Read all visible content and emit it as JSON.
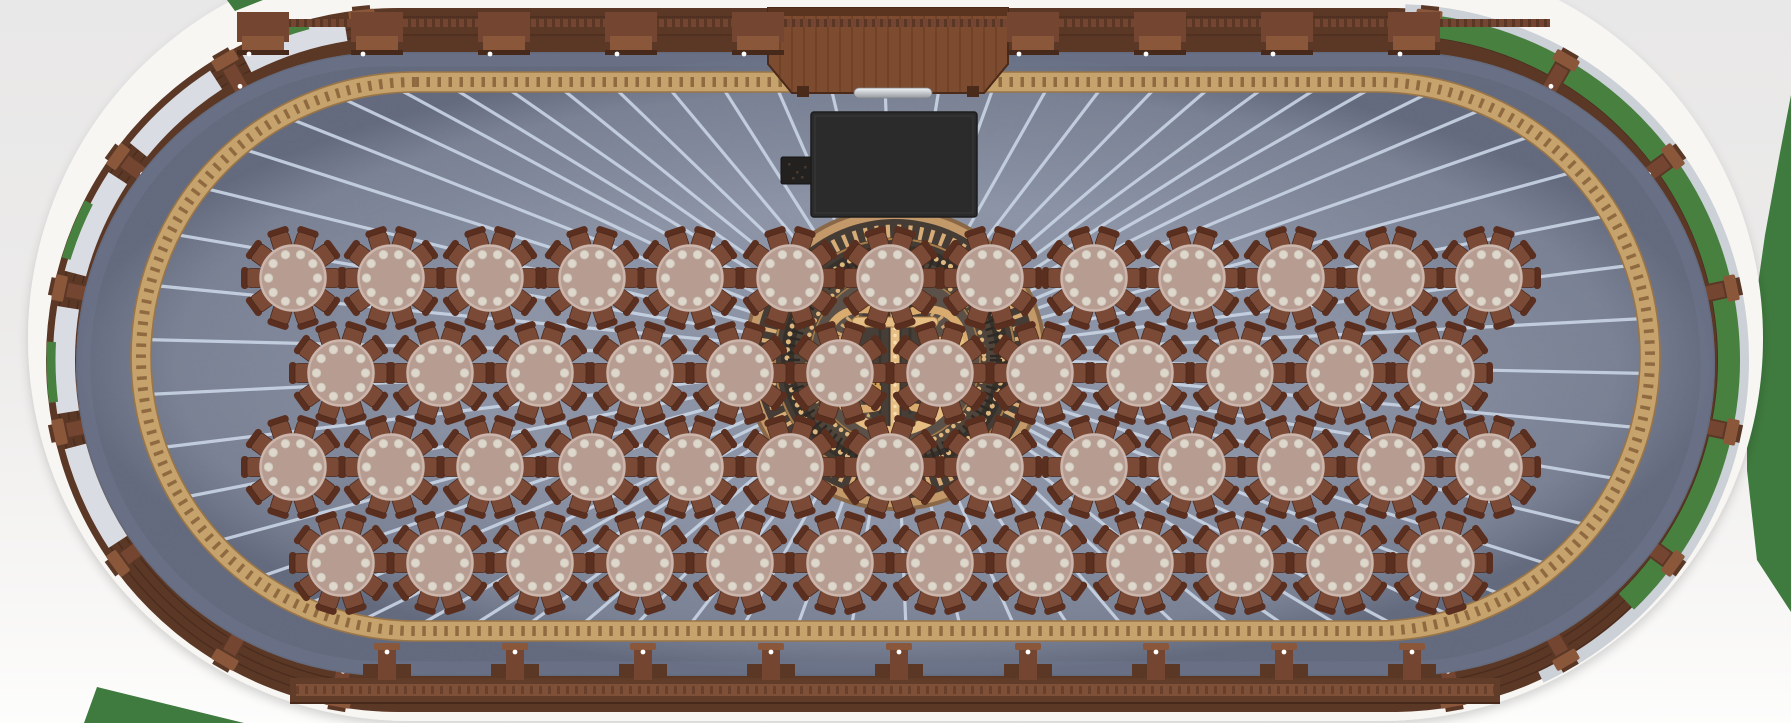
{
  "scene": {
    "title": "Oval banquet hall seating plan (top-down render)",
    "room_shape": "stadium oval with rounded ends",
    "floor": "blue-gray carpet with white sunburst rays radiating from center medallion",
    "centerpiece": "ornate circular wood-inlay medallion with gold anchor motif and laurel rings",
    "table_count": 50,
    "seats_per_table": 10,
    "plates_per_table": 10,
    "total_seats": 500,
    "objects": [
      "round dining tables",
      "dining chairs",
      "grand piano",
      "piano bench",
      "wooden stage platform with footlight bar",
      "laurel border ring",
      "perimeter wood consoles with lamp dots",
      "window bays with white curtains",
      "green outdoors visible through right-end windows"
    ]
  },
  "palette": {
    "wall": "#f7f6f3",
    "wall_shadow": "rgba(60,60,60,0.18)",
    "wood_dark": "#5b3726",
    "wood_mid": "#744631",
    "wood_light": "#8a573a",
    "wood_line": "#46291b",
    "carpet": "#8b93a6",
    "carpet_edge": "#6f7790",
    "ray": "#c7d3e3",
    "ring_gold": "#c6a26c",
    "ring_chevron": "#8f6a40",
    "ring_edge": "#9a7548",
    "curtain": "#d9dce2",
    "glass_green": "#47803f",
    "sill": "#ccd0d7",
    "outside_green": "#3f7a3e",
    "med_rim": "#c3996a",
    "med_rim_edge": "#8a6847",
    "med_ring_dark": "#453c35",
    "med_leaf": "#d7ac76",
    "med_dark2": "#37312b",
    "med_bead": "#dfb67d",
    "med_tex": "#50453b",
    "med_tex_dash": "#2e2924",
    "med_inner": "#5b5148",
    "med_scroll": "#d9ab6e",
    "med_field": "#473f37",
    "med_stripe": "#3b342d",
    "anchor": "#e6bd82",
    "anchor_bead": "#f7ddb0",
    "anchor_edge": "#a87c48",
    "crown": "#d3a254",
    "table_top": "#b79c92",
    "table_rim": "#ccb6ab",
    "plate": "#ded7cb",
    "plate_edge": "#cfc8bb",
    "chair_seat": "#7b4a37",
    "chair_back": "#5a2f20",
    "chair_edge": "#4c2a1c",
    "stage_wood": "#7d4b30",
    "stage_line": "#66391f",
    "stage_trim": "#4a2a19",
    "stage_top": "#5b3420",
    "silver_hi": "#f2f4f6",
    "silver_lo": "#94989e",
    "piano": "#2c2b2b",
    "piano_edge": "#1d1c1c",
    "piano_inner": "#3a3939",
    "bench": "#232120",
    "dot_light": "#ffffff"
  },
  "geometry": {
    "canvas": {
      "w": 1791,
      "h": 723
    },
    "center": {
      "x": 895,
      "y": 358
    },
    "wall": {
      "left": 28,
      "right": 1763,
      "top": -44,
      "bottom": 721
    },
    "wood": {
      "left": 46,
      "right": 1745,
      "top": 8,
      "bottom": 712
    },
    "carpet": {
      "left": 76,
      "right": 1715,
      "top": 52,
      "bottom": 676
    },
    "ring": {
      "left": 141,
      "right": 1650,
      "top": 82,
      "bottom": 631
    },
    "rays": {
      "count": 66,
      "width": 3.2
    },
    "ends": {
      "left_center": {
        "x": 398,
        "y": 360
      },
      "right_center": {
        "x": 1393,
        "y": 360
      },
      "window_alphas": [
        18,
        42,
        66,
        90,
        114
      ],
      "window_half_span": 9,
      "console_alphas": [
        6,
        30,
        54,
        78,
        102,
        126,
        150,
        170
      ],
      "left_green_alphas": [
        20,
        68,
        92
      ],
      "right_green_span": [
        6,
        136
      ],
      "right_sill_span": [
        2,
        155
      ],
      "r_curtain": 334,
      "r_green_left": 347,
      "r_green_right": 336,
      "r_sill": 350,
      "r_console": 324
    },
    "brackets": {
      "top_xs": [
        263,
        377,
        504,
        631,
        758,
        1033,
        1160,
        1287,
        1414
      ],
      "bottom_xs": [
        387,
        515,
        643,
        771,
        899,
        1028,
        1156,
        1284,
        1412
      ]
    }
  },
  "medallion": {
    "cx": 895,
    "cy": 359,
    "outer_r": 152,
    "motif": "gold anchor with crowns, acanthus scrolls, laurel and bead rings"
  },
  "stage": {
    "points": "768,8 1008,8 1008,64 984,93 792,93 768,64",
    "footlight": {
      "x": 854,
      "y": 88,
      "w": 78,
      "h": 10
    }
  },
  "piano": {
    "x": 811,
    "y": 112,
    "w": 166,
    "h": 105,
    "bench": {
      "x": 781,
      "y": 157,
      "w": 34,
      "h": 27
    }
  },
  "tables": {
    "radius": 32.5,
    "chair_count": 10,
    "plate_count": 10,
    "rows": [
      {
        "y": 278,
        "xs": [
          293,
          391,
          490,
          592,
          690,
          790,
          890,
          990,
          1094,
          1192,
          1291,
          1391,
          1489
        ]
      },
      {
        "y": 373,
        "xs": [
          341,
          440,
          540,
          640,
          740,
          840,
          940,
          1040,
          1140,
          1240,
          1340,
          1441
        ]
      },
      {
        "y": 467,
        "xs": [
          293,
          391,
          490,
          592,
          690,
          790,
          890,
          990,
          1094,
          1192,
          1291,
          1391,
          1489
        ]
      },
      {
        "y": 563,
        "xs": [
          341,
          440,
          540,
          640,
          740,
          840,
          940,
          1040,
          1140,
          1240,
          1340,
          1441
        ]
      }
    ]
  },
  "green_accents": {
    "top_right_poly": "1552,0 1791,0 1791,612 1757,560 1747,470 1747,400 1753,320 1765,235 1779,158 1791,95 1791,0",
    "bottom_left_poly": "84,723 244,723 97,687",
    "top_left_poly": "227,0 263,0 235,11"
  }
}
